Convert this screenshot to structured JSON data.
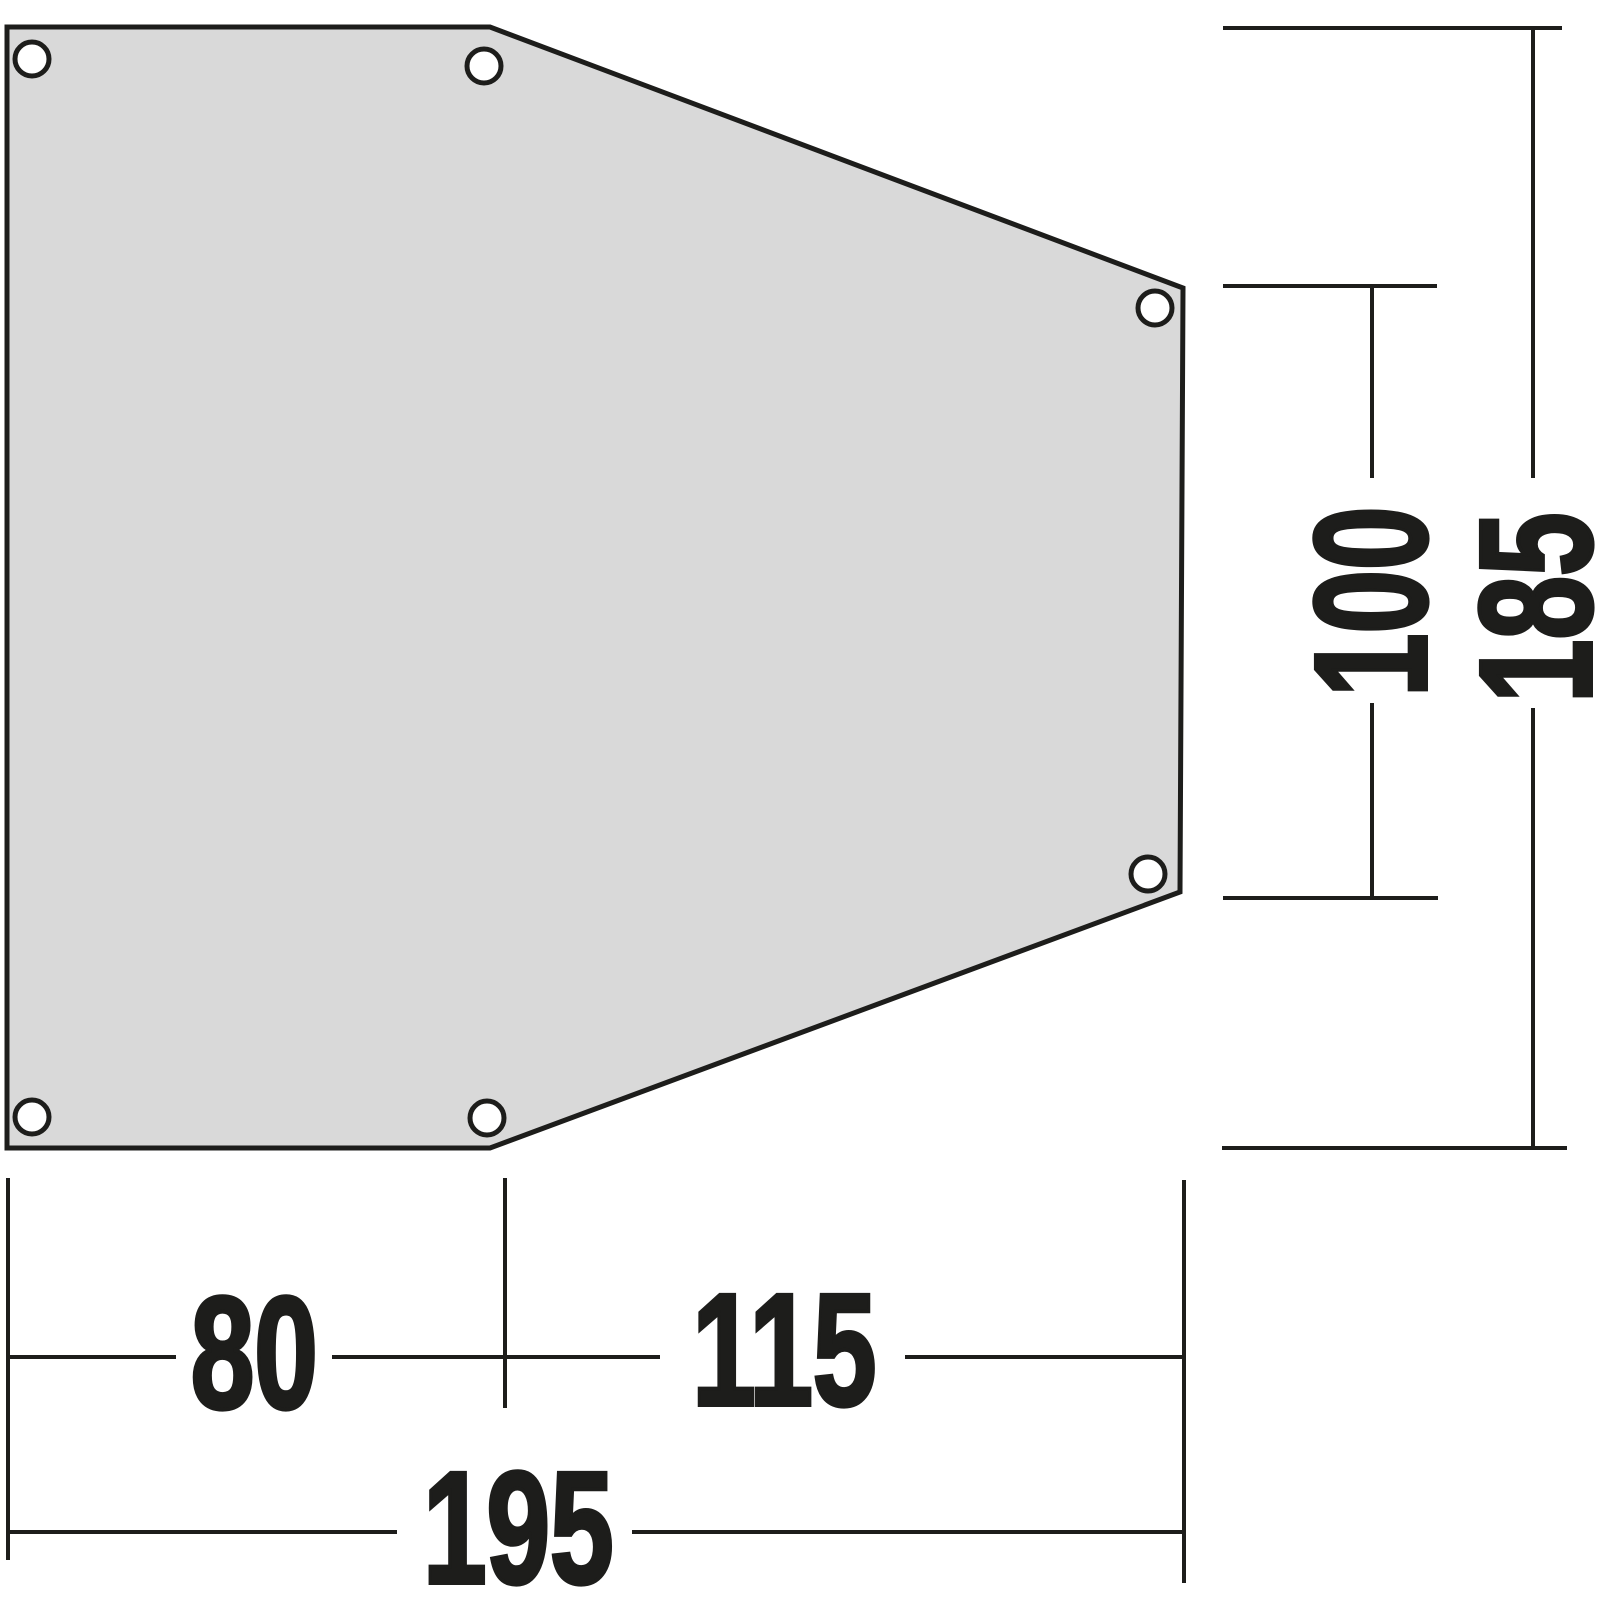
{
  "diagram": {
    "title": "Dimensional drawing of hexagonal tent footprint / groundsheet panel",
    "unit": "cm",
    "shape": {
      "type": "hexagonal-panel",
      "fill_color": "#d9d9d9",
      "line_color": "#1d1d1b",
      "grommet_count": 6
    },
    "dimensions": {
      "width_left_segment": "80",
      "width_right_segment": "115",
      "width_total": "195",
      "height_right_edge": "100",
      "height_total": "185"
    }
  }
}
